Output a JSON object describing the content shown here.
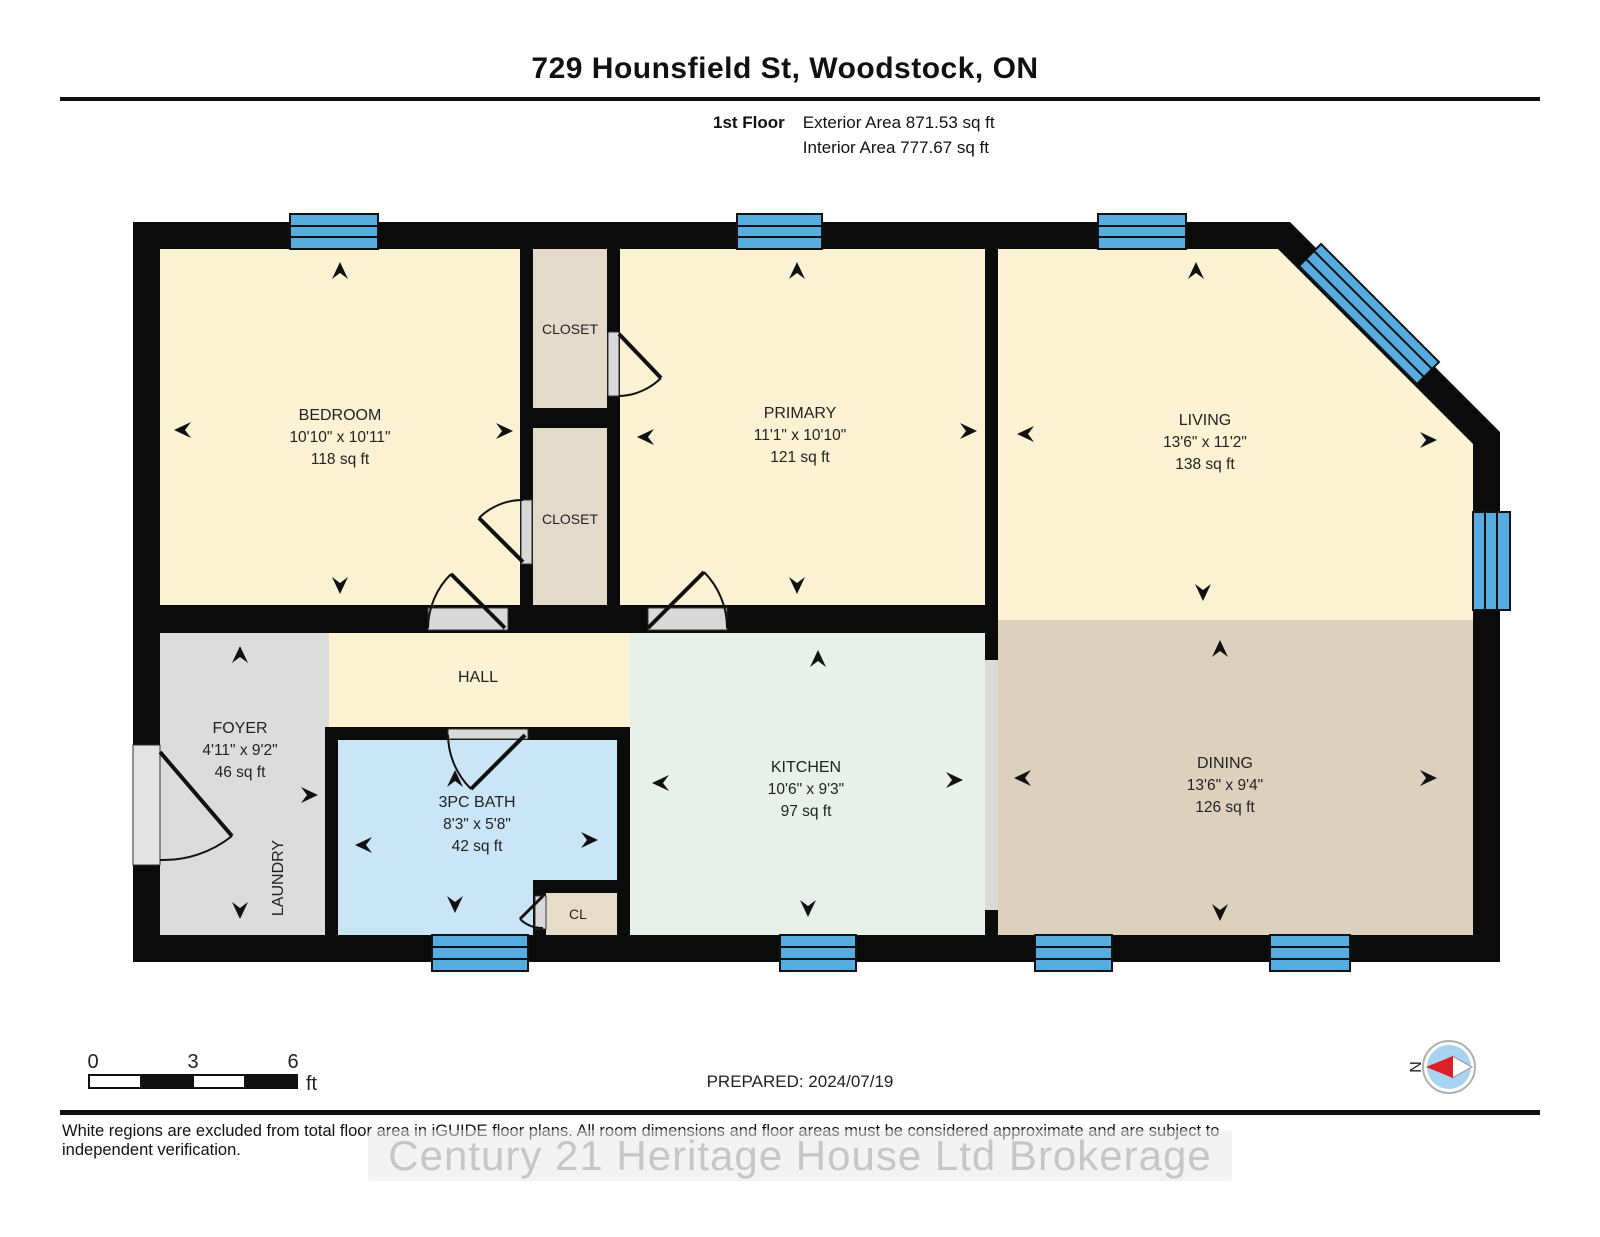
{
  "header": {
    "title": "729 Hounsfield St, Woodstock, ON",
    "floor_label": "1st Floor",
    "exterior_area": "Exterior Area 871.53 sq ft",
    "interior_area": "Interior Area 777.67 sq ft"
  },
  "rooms": {
    "bedroom": {
      "name": "BEDROOM",
      "dims": "10'10\" x 10'11\"",
      "area": "118 sq ft"
    },
    "primary": {
      "name": "PRIMARY",
      "dims": "11'1\" x 10'10\"",
      "area": "121 sq ft"
    },
    "living": {
      "name": "LIVING",
      "dims": "13'6\" x 11'2\"",
      "area": "138 sq ft"
    },
    "dining": {
      "name": "DINING",
      "dims": "13'6\" x 9'4\"",
      "area": "126 sq ft"
    },
    "kitchen": {
      "name": "KITCHEN",
      "dims": "10'6\" x 9'3\"",
      "area": "97 sq ft"
    },
    "bath": {
      "name": "3PC BATH",
      "dims": "8'3\" x 5'8\"",
      "area": "42 sq ft"
    },
    "foyer": {
      "name": "FOYER",
      "dims": "4'11\" x 9'2\"",
      "area": "46 sq ft"
    },
    "hall": {
      "name": "HALL"
    },
    "laundry": {
      "name": "LAUNDRY"
    },
    "closet_top": {
      "name": "CLOSET"
    },
    "closet_bottom": {
      "name": "CLOSET"
    },
    "closet_small": {
      "name": "CL"
    }
  },
  "footer": {
    "scale": {
      "tick0": "0",
      "tick1": "3",
      "tick2": "6",
      "unit": "ft"
    },
    "prepared": "PREPARED: 2024/07/19",
    "compass_north": "N",
    "disclaimer": "White regions are excluded from total floor area in iGUIDE floor plans. All room dimensions and floor areas must be considered approximate and are subject to independent verification.",
    "watermark": "Century 21 Heritage House Ltd Brokerage"
  },
  "colors": {
    "wall": "#0b0b0b",
    "room_cream": "#FBF1D3",
    "closet_tan": "#E3DACA",
    "foyer_gray": "#DCDCDC",
    "bath_blue": "#C9E5F6",
    "kitchen_green": "#E7F0E9",
    "dining_tan": "#DDD1BE",
    "window_blue": "#56ACDF",
    "door_casing": "#D9D9D9",
    "compass_blue": "#A9D4F1",
    "compass_red": "#DD1F26"
  }
}
